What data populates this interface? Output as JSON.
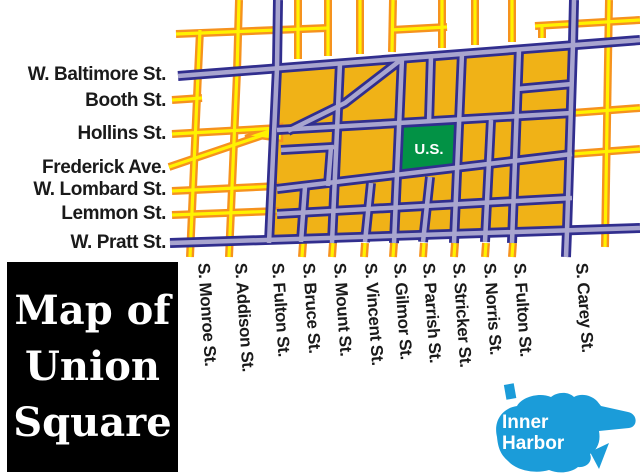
{
  "title_box": {
    "lines": [
      "Map of",
      "Union",
      "Square"
    ]
  },
  "union_square": {
    "label": "U.S.",
    "color": "#029245"
  },
  "inner_harbor": {
    "lines": [
      "Inner",
      "Harbor"
    ],
    "color": "#1B9CD9"
  },
  "colors": {
    "block_gold": "#F0B217",
    "street_purple_outline": "#312E8E",
    "street_purple_fill": "#A8A5CF",
    "street_yellow_outline": "#F6921E",
    "street_yellow_fill": "#FFF200",
    "label_black": "#1a1a1a"
  },
  "streets": {
    "horizontal_labels": [
      {
        "name": "W. Baltimore St.",
        "y": 75
      },
      {
        "name": "Booth St.",
        "y": 101
      },
      {
        "name": "Hollins St.",
        "y": 134
      },
      {
        "name": "Frederick Ave.",
        "y": 168
      },
      {
        "name": "W. Lombard St.",
        "y": 190
      },
      {
        "name": "Lemmon St.",
        "y": 214
      },
      {
        "name": "W. Pratt St.",
        "y": 243
      }
    ],
    "vertical_labels": [
      {
        "name": "S. Monroe St.",
        "x": 204
      },
      {
        "name": "S. Addison St.",
        "x": 241
      },
      {
        "name": "S. Fulton St.",
        "x": 278
      },
      {
        "name": "S. Bruce St.",
        "x": 309
      },
      {
        "name": "S. Mount St.",
        "x": 340
      },
      {
        "name": "S. Vincent St.",
        "x": 371
      },
      {
        "name": "S. Gilmor St.",
        "x": 400
      },
      {
        "name": "S. Parrish St.",
        "x": 429
      },
      {
        "name": "S. Stricker St.",
        "x": 459
      },
      {
        "name": "S. Norris St.",
        "x": 490
      },
      {
        "name": "S. Fulton St.",
        "x": 520
      },
      {
        "name": "S. Carey St.",
        "x": 582
      }
    ]
  }
}
